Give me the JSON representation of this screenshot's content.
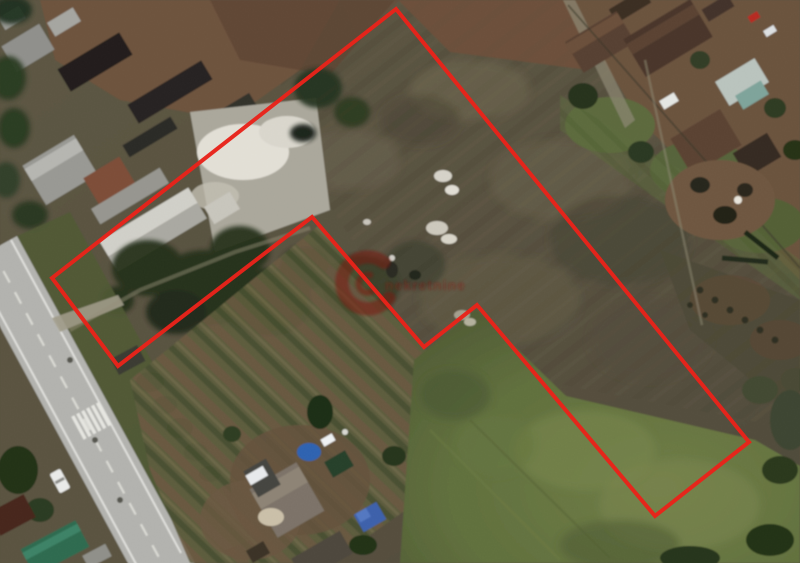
{
  "boundary": {
    "points": "396,9 749,442 655,516 477,305 424,347 312,217 118,366 52,278",
    "stroke": "#e8231a",
    "stroke_width": "4"
  },
  "watermark": {
    "text": "nekretnine",
    "color": "#8f1510",
    "logo": "g-ring-logo"
  },
  "palette": {
    "terrain_base": "#57503e",
    "plowed_field": "#6e503a",
    "green_field": "#5f6e3c",
    "trees": "#26301c",
    "road": "#b2b2ae",
    "road_markings": "#e9e9e4",
    "concrete_pad": "#d9d6cc",
    "blue_tarp": "#2e62b0",
    "boundary_red": "#e8231a",
    "watermark_red": "#8f1510"
  }
}
